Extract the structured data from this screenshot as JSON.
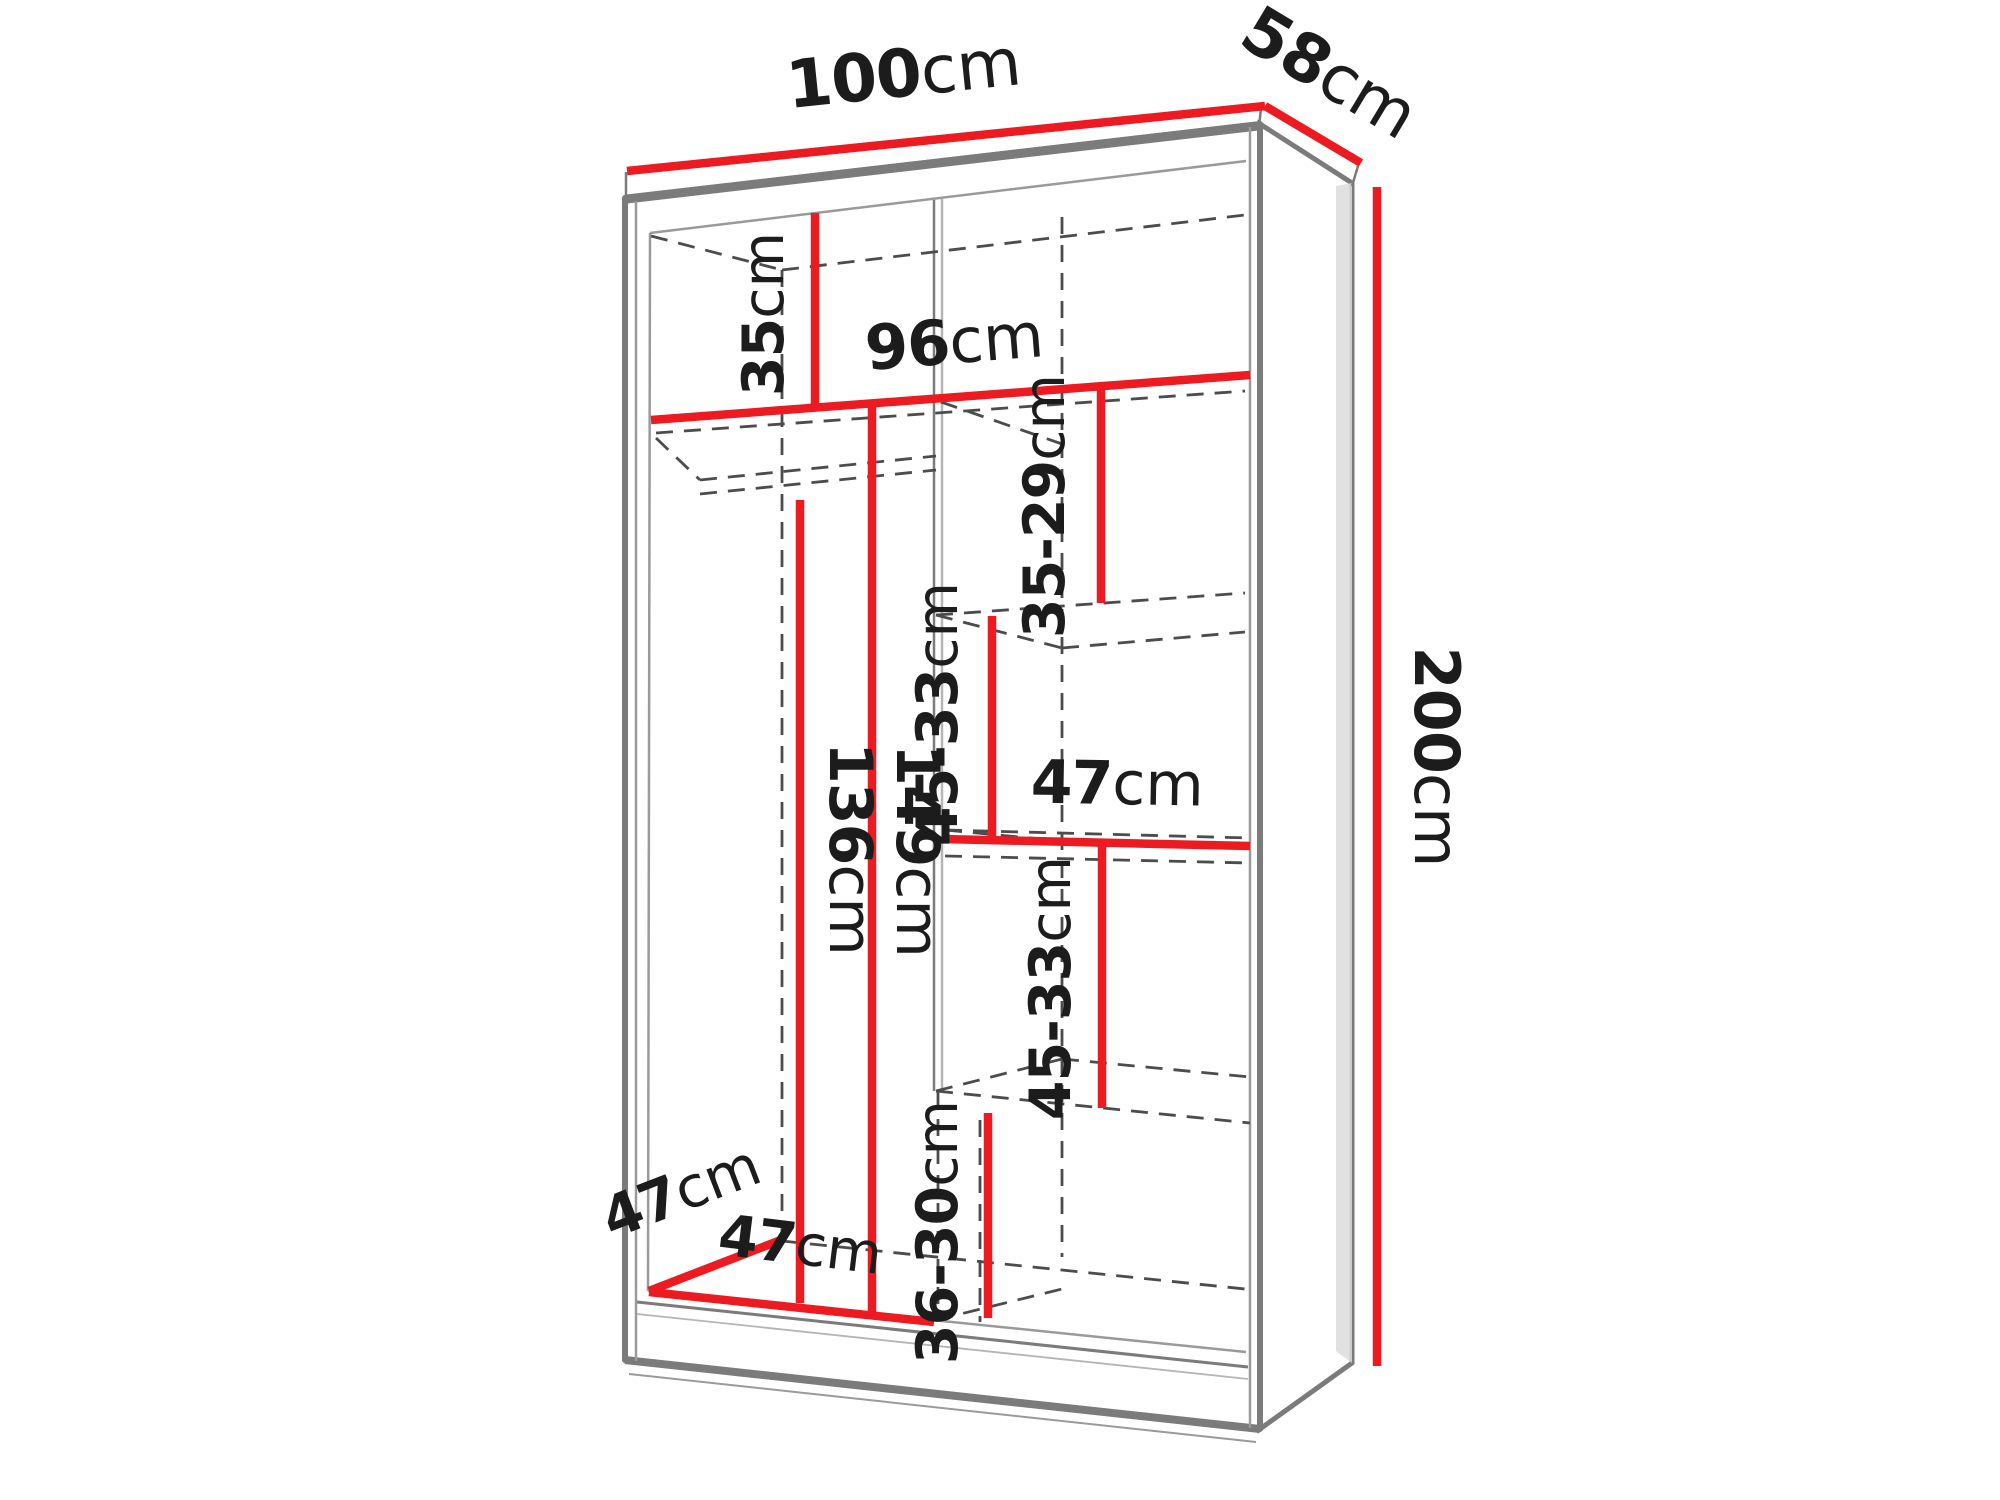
{
  "diagram": {
    "kind": "wardrobe-interior-dimension-diagram",
    "unit": "cm",
    "view": "three-quarter perspective line drawing, dimensions highlighted in red"
  },
  "colors": {
    "dimension_red": "#ec1b21",
    "text": "#1c1c1c",
    "edge_gray": "#7b7b7b",
    "dash_gray": "#4c4c4c",
    "background": "#ffffff"
  },
  "dims": {
    "overall_width": {
      "num": "100",
      "unit": "cm"
    },
    "overall_depth": {
      "num": "58",
      "unit": "cm"
    },
    "overall_height": {
      "num": "200",
      "unit": "cm"
    },
    "top_compartment_height": {
      "num": "35",
      "unit": "cm"
    },
    "interior_width": {
      "num": "96",
      "unit": "cm"
    },
    "right_top_gap": {
      "num": "35-29",
      "unit": "cm"
    },
    "right_upper_gap": {
      "num": "45-33",
      "unit": "cm"
    },
    "middle_shelf_width": {
      "num": "47",
      "unit": "cm"
    },
    "right_lower_gap": {
      "num": "45-33",
      "unit": "cm"
    },
    "right_bottom_gap": {
      "num": "36-30",
      "unit": "cm"
    },
    "hanging_clear_height": {
      "num": "136",
      "unit": "cm"
    },
    "left_section_height": {
      "num": "149",
      "unit": "cm"
    },
    "interior_depth": {
      "num": "47",
      "unit": "cm"
    },
    "left_section_width": {
      "num": "47",
      "unit": "cm"
    }
  }
}
